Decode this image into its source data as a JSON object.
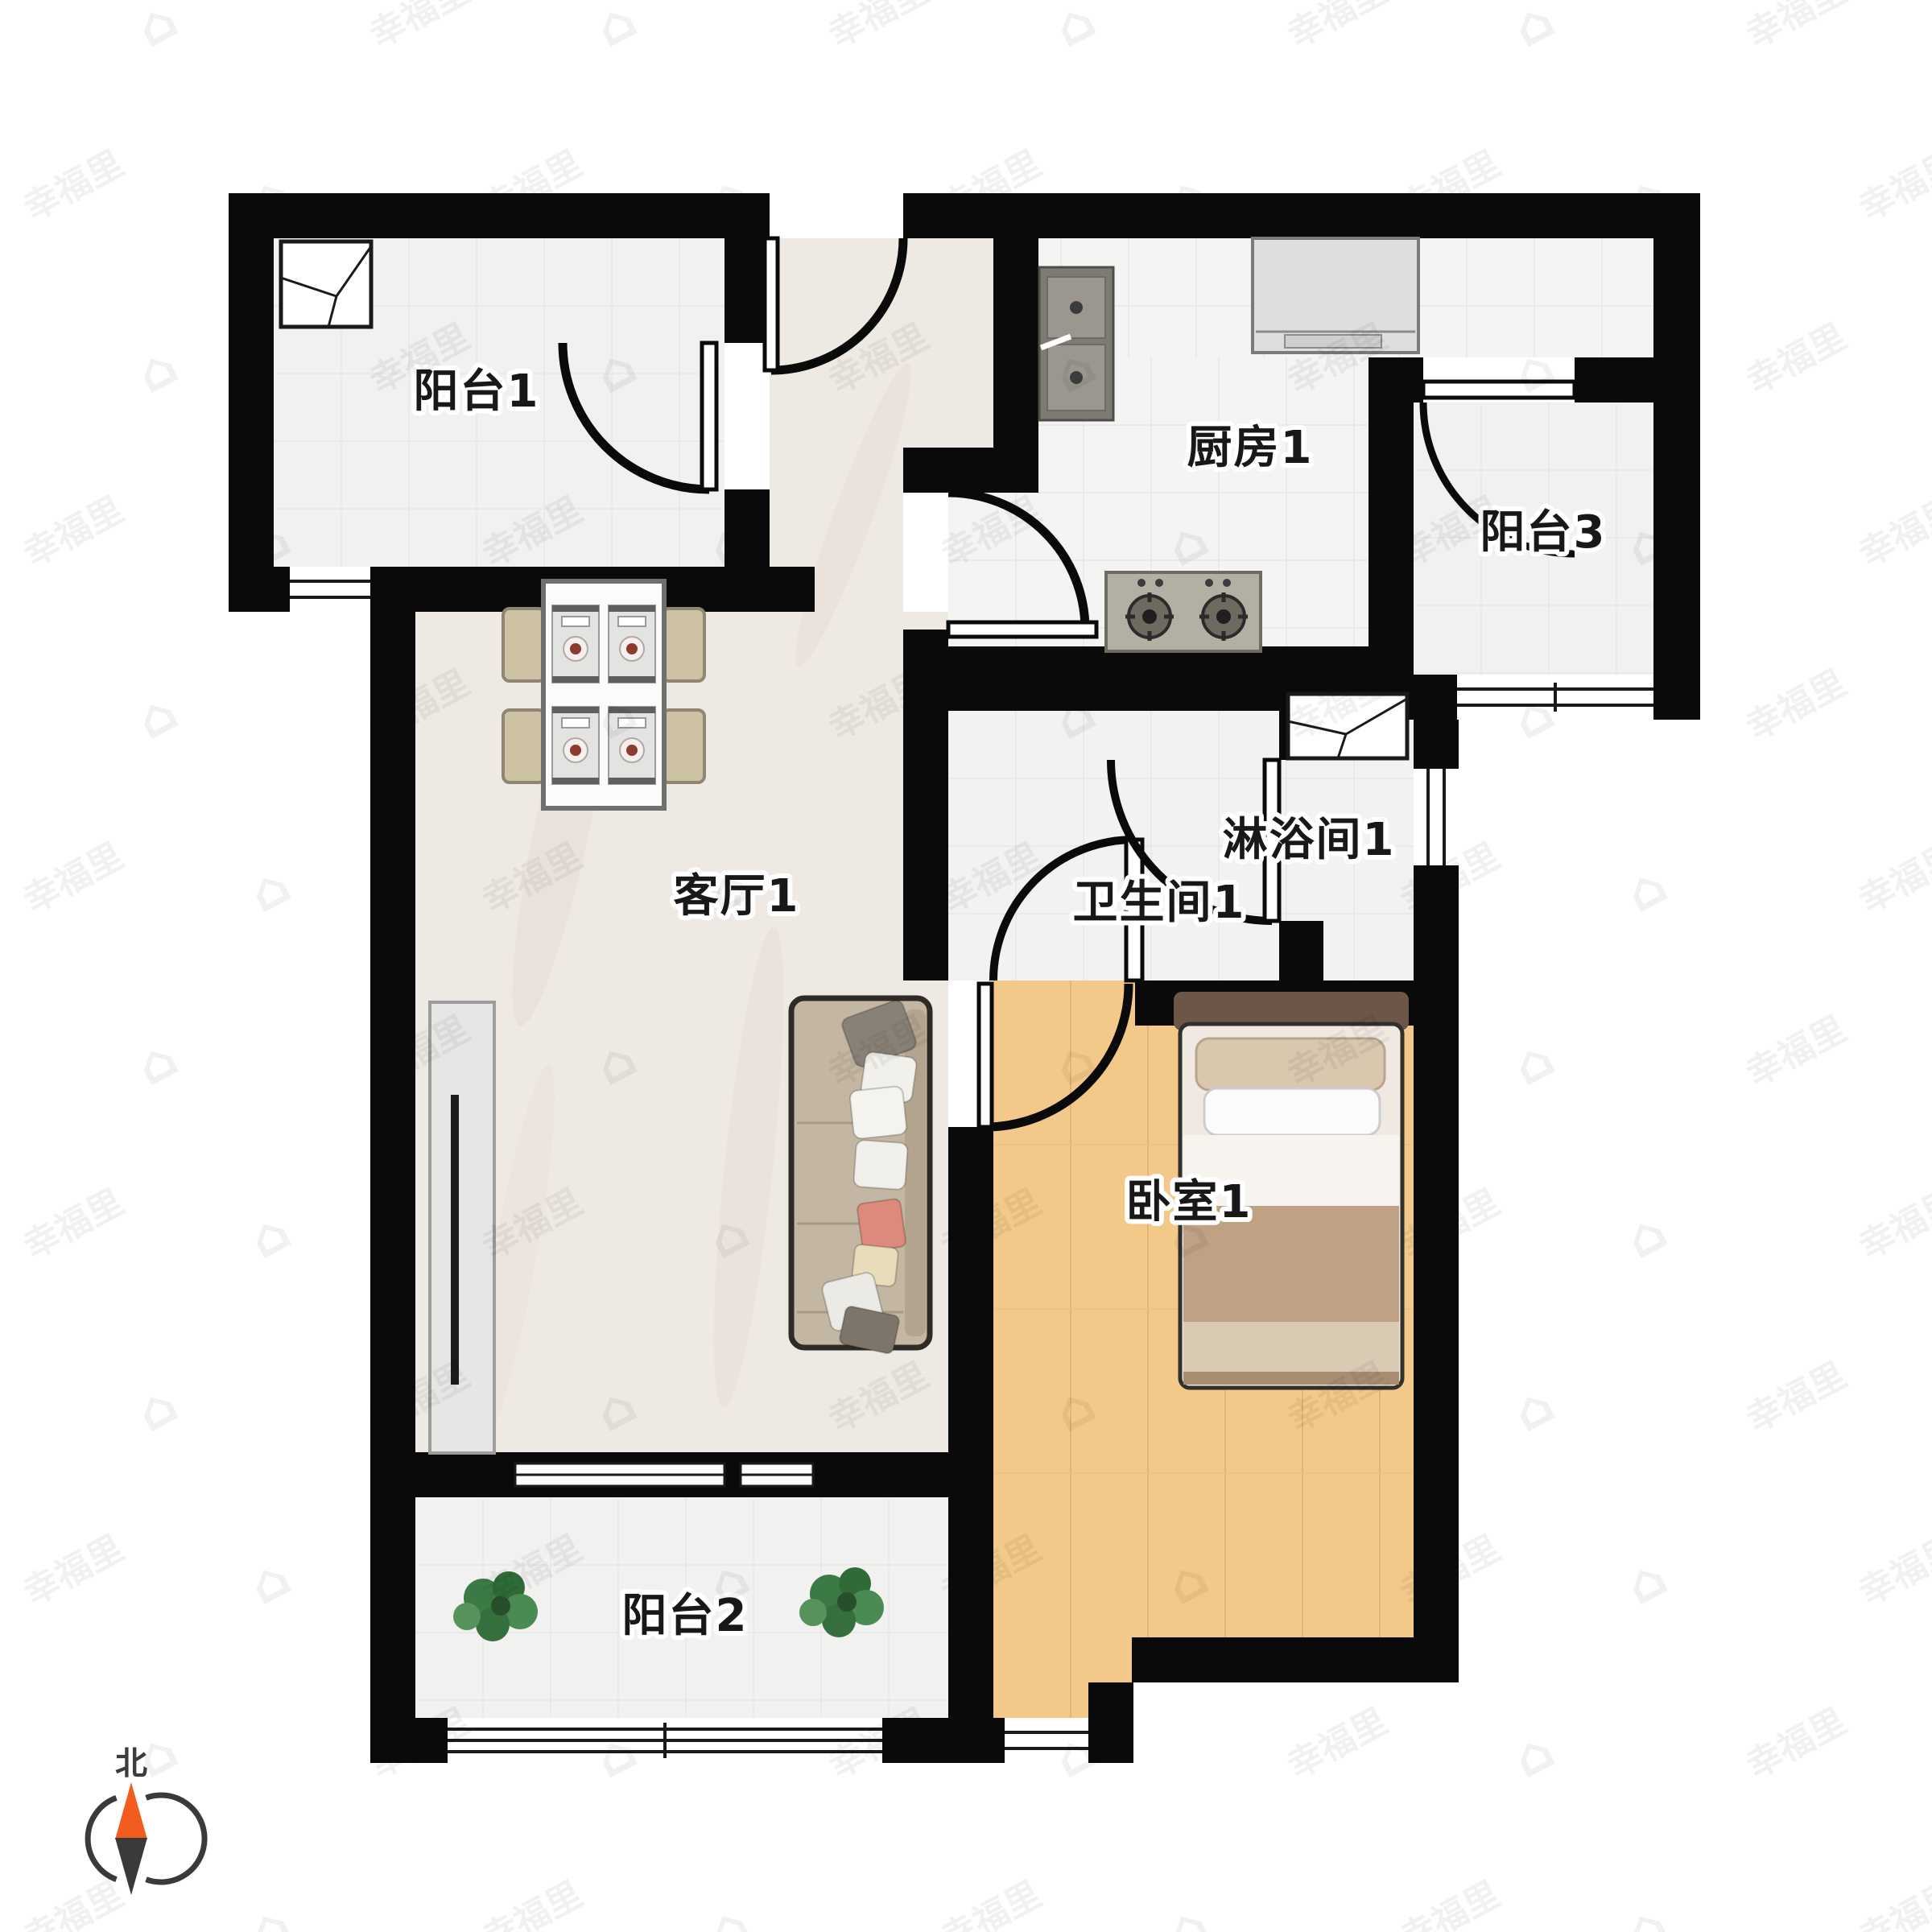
{
  "rooms": {
    "balcony1": "阳台1",
    "kitchen": "厨房1",
    "balcony3": "阳台3",
    "living": "客厅1",
    "shower": "淋浴间1",
    "bathroom": "卫生间1",
    "bedroom": "卧室1",
    "balcony2": "阳台2"
  },
  "compass": {
    "north_label": "北"
  },
  "watermark": {
    "text": "幸福里",
    "icon": "house-icon"
  },
  "colors": {
    "wall": "#0a0a0a",
    "wood_floor": "#f2c989",
    "tile_floor": "#f1f1f0",
    "marble_floor": "#efe9e3",
    "compass_north": "#f25c1e",
    "plant_green": "#41804a",
    "plate_red": "#b43a2e"
  }
}
